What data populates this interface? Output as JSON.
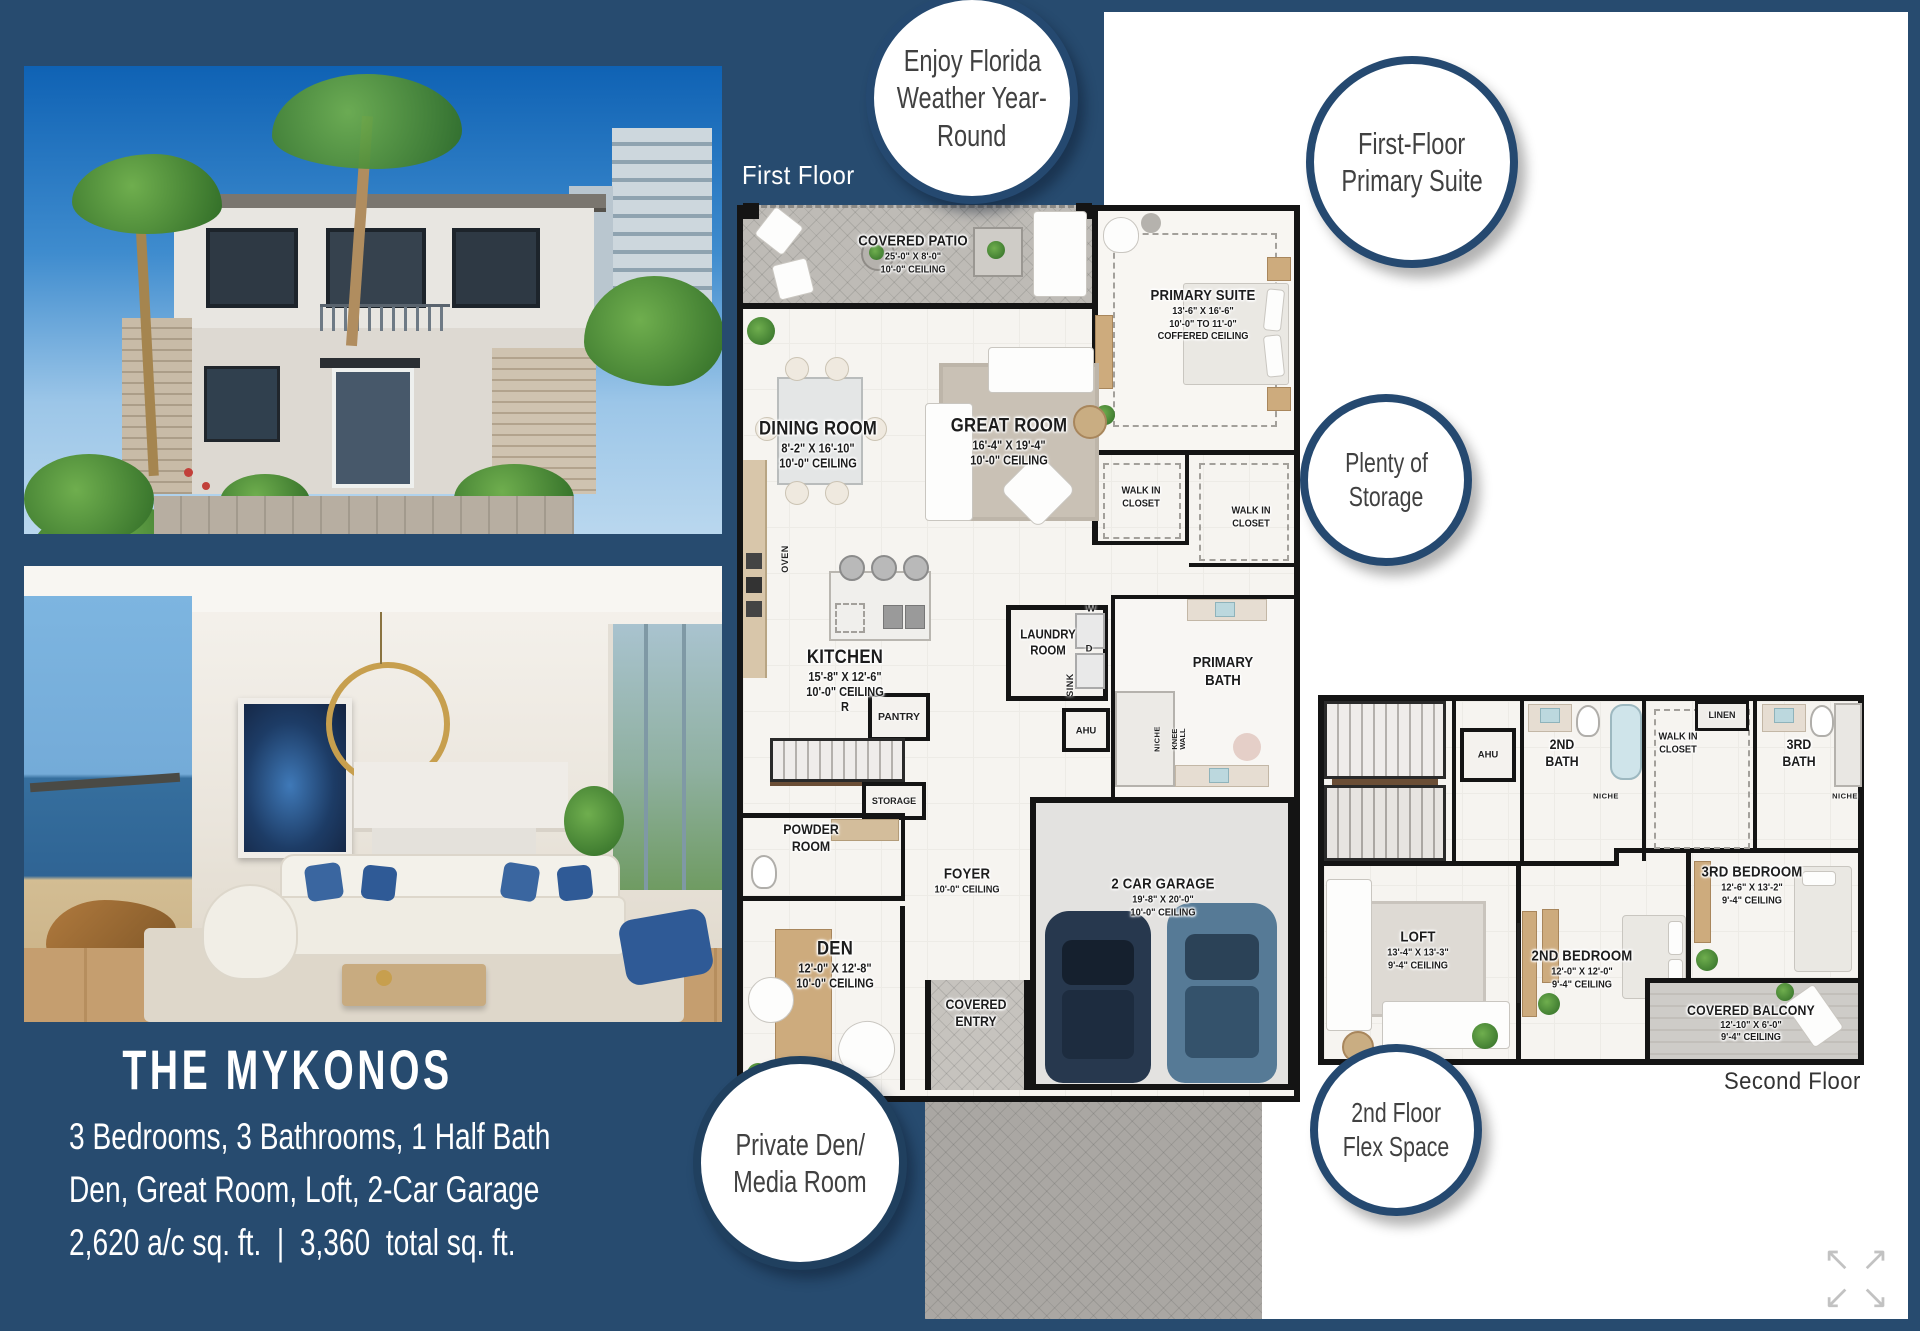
{
  "colors": {
    "navy": "#274b6f",
    "circle_ring": "#254970",
    "wall": "#141414"
  },
  "left_panel": {
    "title": "THE MYKONOS",
    "specs": [
      "3 Bedrooms, 3 Bathrooms, 1 Half Bath",
      "Den, Great Room, Loft, 2-Car Garage",
      "2,620 a/c sq. ft.  |  3,360  total sq. ft."
    ]
  },
  "callouts": {
    "weather": {
      "lines": [
        "Enjoy Florida",
        "Weather Year-",
        "Round"
      ]
    },
    "primary": {
      "lines": [
        "First-Floor",
        "Primary Suite"
      ]
    },
    "storage": {
      "lines": [
        "Plenty of",
        "Storage"
      ]
    },
    "den": {
      "lines": [
        "Private Den/",
        "Media Room"
      ]
    },
    "flex": {
      "lines": [
        "2nd Floor",
        "Flex Space"
      ]
    }
  },
  "first_floor": {
    "heading": "First Floor",
    "rooms": {
      "patio": {
        "name": "COVERED PATIO",
        "dims": "25'-0\" X 8'-0\"",
        "ceiling": "10'-0\" CEILING"
      },
      "suite": {
        "name": "PRIMARY SUITE",
        "dims": "13'-6\" X 16'-6\"",
        "ceiling": "10'-0\"  TO  11'-0\"",
        "ceiling2": "COFFERED CEILING"
      },
      "dining": {
        "name": "DINING ROOM",
        "dims": "8'-2\" X 16'-10\"",
        "ceiling": "10'-0\" CEILING"
      },
      "great": {
        "name": "GREAT ROOM",
        "dims": "16'-4\" X 19'-4\"",
        "ceiling": "10'-0\" CEILING"
      },
      "wic1": {
        "line1": "WALK IN",
        "line2": "CLOSET"
      },
      "wic2": {
        "line1": "WALK IN",
        "line2": "CLOSET"
      },
      "kitchen": {
        "name": "KITCHEN",
        "dims": "15'-8\" X 12'-6\"",
        "ceiling": "10'-0\" CEILING",
        "fridge": "R"
      },
      "laundry": {
        "line1": "LAUNDRY",
        "line2": "ROOM"
      },
      "bath": {
        "line1": "PRIMARY",
        "line2": "BATH"
      },
      "pantry": "PANTRY",
      "storage": "STORAGE",
      "powder": {
        "line1": "POWDER",
        "line2": "ROOM"
      },
      "foyer": {
        "name": "FOYER",
        "ceiling": "10'-0\" CEILING"
      },
      "den": {
        "name": "DEN",
        "dims": "12'-0\" X 12'-8\"",
        "ceiling": "10'-0\" CEILING"
      },
      "entry": {
        "line1": "COVERED",
        "line2": "ENTRY"
      },
      "garage": {
        "name": "2 CAR GARAGE",
        "dims": "19'-8\" X 20'-0\"",
        "ceiling": "10'-0\" CEILING"
      }
    },
    "tags": {
      "oven": "OVEN",
      "washer": "W",
      "dryer": "D",
      "sink": "SINK",
      "ahu": "AHU",
      "niche": "NICHE",
      "knee1": "KNEE",
      "knee2": "WALL"
    }
  },
  "second_floor": {
    "heading": "Second Floor",
    "rooms": {
      "ahu": "AHU",
      "bath2": {
        "line1": "2ND",
        "line2": "BATH"
      },
      "wic": {
        "line1": "WALK IN",
        "line2": "CLOSET"
      },
      "linen": "LINEN",
      "bath3": {
        "line1": "3RD",
        "line2": "BATH"
      },
      "niche": "NICHE",
      "bed3": {
        "name": "3RD BEDROOM",
        "dims": "12'-6\" X 13'-2\"",
        "ceiling": "9'-4\" CEILING"
      },
      "loft": {
        "name": "LOFT",
        "dims": "13'-4\" X 13'-3\"",
        "ceiling": "9'-4\" CEILING"
      },
      "bed2": {
        "name": "2ND BEDROOM",
        "dims": "12'-0\" X 12'-0\"",
        "ceiling": "9'-4\" CEILING"
      },
      "balcony": {
        "name": "COVERED BALCONY",
        "dims": "12'-10\" X 6'-0\"",
        "ceiling": "9'-4\" CEILING"
      }
    }
  },
  "controls": {
    "expand": {
      "tl": "↖",
      "tr": "↗",
      "bl": "↙",
      "br": "↘"
    }
  }
}
